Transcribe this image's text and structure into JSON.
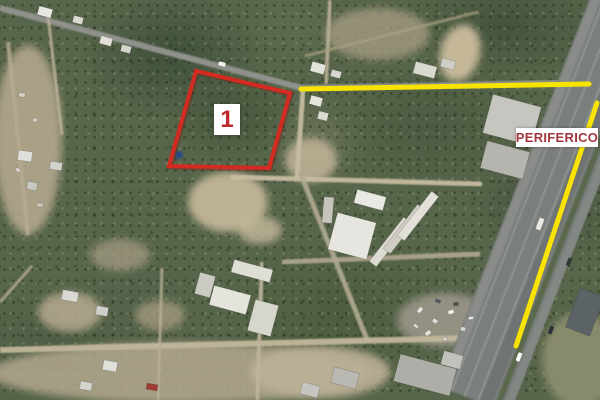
{
  "image": {
    "width": 600,
    "height": 400,
    "kind": "aerial-satellite-photo"
  },
  "annotations": {
    "parcel_polygon": {
      "points": "196,71 290,93 269,168 169,166",
      "stroke": "#d32b21",
      "stroke_width": 4
    },
    "highlight_lines": [
      {
        "id": "top-road",
        "x1": 301,
        "y1": 89,
        "x2": 589,
        "y2": 84,
        "stroke": "#f8e400",
        "width": 5
      },
      {
        "id": "periferico-highway",
        "x1": 597,
        "y1": 103,
        "x2": 516,
        "y2": 346,
        "stroke": "#f8e400",
        "width": 5
      }
    ],
    "parcel_label": {
      "text": "1",
      "x": 214,
      "y": 104,
      "w": 26,
      "h": 31,
      "bg": "#ffffff",
      "color": "#c1282d",
      "font_size": 24
    },
    "road_label": {
      "text": "PERIFERICO",
      "x": 516,
      "y": 128,
      "w": 82,
      "h": 19,
      "bg": "#ffffff",
      "color": "#a2363b",
      "font_size": 13
    }
  },
  "map": {
    "palette": {
      "vegetation": "#57654a",
      "paved_road": "#8f918c",
      "dirt_road": "#c6bca2",
      "highway": "#7a7e7c",
      "dirt": "#b8ad92",
      "highlight_yellow": "#f8e400",
      "annotation_red": "#d32b21"
    },
    "patches": [
      [
        28,
        140,
        34,
        95,
        "#b2a78d",
        0.9,
        0
      ],
      [
        228,
        202,
        40,
        30,
        "#c2b699",
        0.95,
        0
      ],
      [
        460,
        53,
        20,
        29,
        "#cbbd9e",
        0.95,
        15
      ],
      [
        180,
        373,
        190,
        30,
        "#b3a98f",
        0.85,
        0
      ],
      [
        320,
        372,
        70,
        26,
        "#bcb196",
        0.9,
        0
      ],
      [
        580,
        360,
        38,
        48,
        "#8e8f6f",
        0.9,
        0
      ],
      [
        311,
        160,
        26,
        22,
        "#bdb195",
        0.9,
        0
      ],
      [
        378,
        34,
        52,
        26,
        "#a89f85",
        0.75,
        0
      ],
      [
        445,
        320,
        48,
        27,
        "#9b9689",
        0.9,
        0
      ],
      [
        70,
        312,
        32,
        20,
        "#b6ab90",
        0.85,
        0
      ],
      [
        120,
        255,
        30,
        16,
        "#a99f86",
        0.7,
        0
      ],
      [
        260,
        230,
        22,
        14,
        "#c6ba9d",
        0.8,
        0
      ],
      [
        160,
        315,
        25,
        15,
        "#ada283",
        0.7,
        0
      ]
    ],
    "roads": [
      [
        0,
        8,
        302,
        88,
        6,
        "#8f918c",
        1
      ],
      [
        302,
        88,
        600,
        82,
        6,
        "#8f918c",
        1
      ],
      [
        48,
        16,
        62,
        135,
        3,
        "#bdb399",
        0.85
      ],
      [
        330,
        0,
        326,
        84,
        4,
        "#b7ae95",
        0.9
      ],
      [
        305,
        56,
        478,
        12,
        3,
        "#aba081",
        0.7
      ],
      [
        303,
        90,
        297,
        178,
        5,
        "#c6bca2",
        0.95
      ],
      [
        230,
        177,
        482,
        184,
        5,
        "#c6bca2",
        0.95
      ],
      [
        300,
        172,
        368,
        342,
        5,
        "#b3ab93",
        0.9
      ],
      [
        282,
        262,
        480,
        254,
        5,
        "#b0a890",
        0.9
      ],
      [
        0,
        350,
        470,
        338,
        6,
        "#c2b79c",
        0.95
      ],
      [
        262,
        262,
        257,
        400,
        4,
        "#bfb59b",
        0.9
      ],
      [
        162,
        268,
        158,
        400,
        3,
        "#b9af95",
        0.8
      ],
      [
        8,
        42,
        28,
        235,
        4,
        "#b7ac91",
        0.8
      ],
      [
        0,
        302,
        32,
        266,
        3,
        "#b9ae93",
        0.8
      ],
      [
        630,
        0,
        474,
        400,
        76,
        "#7a7e7c",
        1
      ],
      [
        600.2,
        -11.6,
        444.2,
        388.4,
        9,
        "#8a8d89",
        0.95
      ],
      [
        607.6,
        -8.7,
        451.6,
        391.3,
        1.5,
        "#a2a5a1",
        0.75
      ],
      [
        620.7,
        -3.6,
        464.7,
        396.4,
        1.5,
        "#a2a5a1",
        0.75
      ],
      [
        633.7,
        1.5,
        477.7,
        401.5,
        1.5,
        "#a2a5a1",
        0.75
      ],
      [
        641.2,
        4.4,
        485.2,
        404.4,
        12,
        "#6e7271",
        0.9
      ],
      [
        652.4,
        8.7,
        496.4,
        408.7,
        6,
        "#5a674d",
        1
      ],
      [
        661.7,
        12.4,
        505.7,
        412.4,
        8,
        "#868a86",
        0.9
      ]
    ],
    "buildings": [
      [
        352,
        236,
        40,
        38,
        15,
        "#e6e5e0"
      ],
      [
        390,
        242,
        56,
        9,
        -52,
        "#dcdad2"
      ],
      [
        404,
        229,
        56,
        9,
        -52,
        "#cfcdc4"
      ],
      [
        418,
        216,
        56,
        9,
        -52,
        "#e2e0d8"
      ],
      [
        370,
        200,
        30,
        14,
        15,
        "#e9e8e2"
      ],
      [
        328,
        210,
        10,
        26,
        5,
        "#c6c4bb"
      ],
      [
        512,
        120,
        50,
        40,
        15,
        "#c6c5bf"
      ],
      [
        505,
        160,
        44,
        28,
        15,
        "#b5b4ae"
      ],
      [
        318,
        68,
        14,
        10,
        15,
        "#e3e2da"
      ],
      [
        336,
        74,
        10,
        7,
        15,
        "#d8d7cf"
      ],
      [
        316,
        101,
        12,
        9,
        15,
        "#e6e5dd"
      ],
      [
        323,
        116,
        10,
        8,
        15,
        "#dcdbd3"
      ],
      [
        45,
        12,
        14,
        9,
        15,
        "#e8e7e1"
      ],
      [
        78,
        20,
        10,
        7,
        15,
        "#dcdbd3"
      ],
      [
        106,
        41,
        12,
        8,
        15,
        "#e2e1d9"
      ],
      [
        126,
        49,
        10,
        7,
        15,
        "#d6d5cd"
      ],
      [
        25,
        156,
        14,
        10,
        8,
        "#dededa"
      ],
      [
        56,
        166,
        12,
        8,
        8,
        "#d2d2cc"
      ],
      [
        32,
        186,
        10,
        8,
        8,
        "#c8c8c2"
      ],
      [
        230,
        300,
        38,
        20,
        15,
        "#e4e3dc"
      ],
      [
        263,
        318,
        24,
        32,
        15,
        "#d7d6cd"
      ],
      [
        252,
        271,
        40,
        13,
        15,
        "#dfded6"
      ],
      [
        205,
        285,
        16,
        22,
        15,
        "#cbcac2"
      ],
      [
        70,
        296,
        16,
        10,
        10,
        "#d9d8d2"
      ],
      [
        102,
        311,
        12,
        9,
        10,
        "#cfcec8"
      ],
      [
        110,
        366,
        14,
        10,
        10,
        "#e0dfd9"
      ],
      [
        86,
        386,
        12,
        8,
        10,
        "#d4d3cd"
      ],
      [
        152,
        387,
        11,
        6,
        10,
        "#9e3b32"
      ],
      [
        425,
        375,
        58,
        28,
        15,
        "#aeaea9"
      ],
      [
        452,
        360,
        20,
        14,
        15,
        "#c2c2bc"
      ],
      [
        585,
        312,
        42,
        26,
        -69,
        "#5c6366"
      ],
      [
        425,
        70,
        22,
        12,
        15,
        "#dad9d1"
      ],
      [
        448,
        64,
        14,
        9,
        15,
        "#cfcec6"
      ],
      [
        345,
        378,
        26,
        16,
        15,
        "#b9b8b2"
      ],
      [
        310,
        390,
        18,
        12,
        15,
        "#c5c4be"
      ]
    ],
    "debris": [
      [
        420,
        310,
        6,
        4,
        -50,
        "#e7e7e1"
      ],
      [
        435,
        321,
        5,
        4,
        30,
        "#dededa"
      ],
      [
        451,
        312,
        6,
        4,
        -20,
        "#eeede7"
      ],
      [
        463,
        329,
        5,
        4,
        10,
        "#d8d8d2"
      ],
      [
        428,
        333,
        6,
        4,
        -35,
        "#e3e3dd"
      ],
      [
        445,
        339,
        5,
        3,
        15,
        "#d5d5cf"
      ],
      [
        471,
        318,
        5,
        3,
        -10,
        "#e9e9e3"
      ],
      [
        416,
        326,
        5,
        3,
        40,
        "#dcdcd6"
      ],
      [
        456,
        304,
        5,
        3,
        0,
        "#4a4e52"
      ],
      [
        438,
        301,
        5,
        3,
        20,
        "#54585c"
      ],
      [
        22,
        95,
        6,
        4,
        10,
        "#d8d4c8"
      ],
      [
        35,
        120,
        5,
        4,
        -15,
        "#cfcabe"
      ],
      [
        18,
        170,
        5,
        4,
        25,
        "#d2cec2"
      ],
      [
        40,
        205,
        6,
        4,
        0,
        "#c9c5b9"
      ]
    ],
    "vehicles": [
      [
        222,
        64,
        7,
        4,
        15,
        "#f2f2ee"
      ],
      [
        519,
        357,
        4,
        9,
        21,
        "#fafaf6"
      ],
      [
        551,
        330,
        4,
        8,
        21,
        "#2e3236"
      ],
      [
        540,
        224,
        5,
        12,
        21,
        "#e8e8e2"
      ],
      [
        569,
        262,
        4,
        8,
        21,
        "#33373a"
      ]
    ],
    "water_dot": {
      "cx": 179,
      "cy": 155,
      "r": 4,
      "color": "#2b4a8c"
    }
  }
}
